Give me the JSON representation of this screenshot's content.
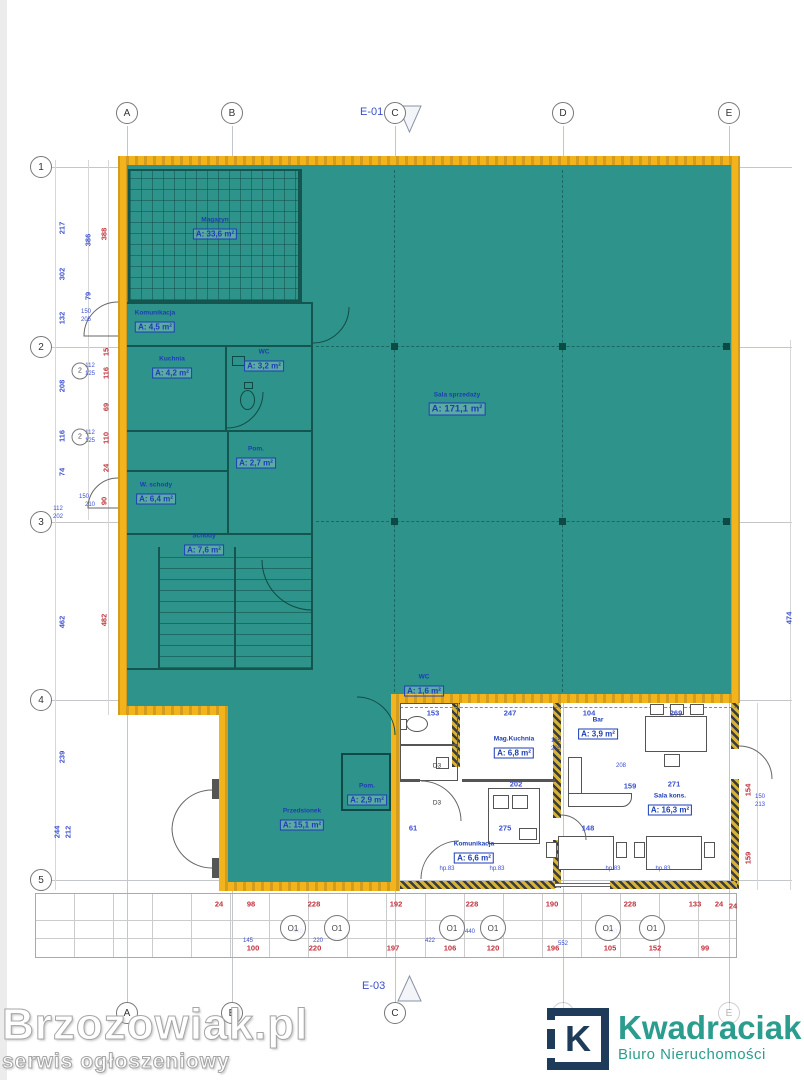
{
  "colors": {
    "highlight_fill": "#2E938A",
    "highlight_border": "#F3B31C",
    "dim_red": "#C2303A",
    "dim_blue": "#3A4FD0",
    "room_label": "#1C3DB4",
    "logo_navy": "#1E3C5A",
    "brand_teal": "#2A9D8F"
  },
  "section_markers": {
    "top": "E-01",
    "bottom": "E-03"
  },
  "grid": {
    "columns": [
      {
        "label": "A",
        "x": 127
      },
      {
        "label": "B",
        "x": 232
      },
      {
        "label": "C",
        "x": 395
      },
      {
        "label": "D",
        "x": 563
      },
      {
        "label": "E",
        "x": 729
      }
    ],
    "rows": [
      {
        "label": "1",
        "y": 167
      },
      {
        "label": "2",
        "y": 347
      },
      {
        "label": "3",
        "y": 522
      },
      {
        "label": "4",
        "y": 700
      },
      {
        "label": "5",
        "y": 880
      }
    ]
  },
  "rooms": [
    {
      "name": "Magazyn",
      "area": "A: 33,6 m²",
      "x": 215,
      "y": 229
    },
    {
      "name": "Komunikacja",
      "area": "A: 4,5 m²",
      "x": 155,
      "y": 322
    },
    {
      "name": "Kuchnia",
      "area": "A: 4,2 m²",
      "x": 172,
      "y": 368
    },
    {
      "name": "WC",
      "area": "A: 3,2 m²",
      "x": 264,
      "y": 361
    },
    {
      "name": "Pom.",
      "area": "A: 2,7 m²",
      "x": 256,
      "y": 458
    },
    {
      "name": "W. schody",
      "area": "A: 6,4 m²",
      "x": 156,
      "y": 494
    },
    {
      "name": "Schody",
      "area": "A: 7,6 m²",
      "x": 204,
      "y": 545
    },
    {
      "name": "Sala sprzedaży",
      "area": "A: 171,1 m²",
      "x": 457,
      "y": 404,
      "cls": "lg"
    },
    {
      "name": "WC",
      "area": "A: 1,6 m²",
      "x": 424,
      "y": 686
    },
    {
      "name": "Pom.",
      "area": "A: 2,9 m²",
      "x": 367,
      "y": 795
    },
    {
      "name": "Przedsionek",
      "area": "A: 15,1 m²",
      "x": 302,
      "y": 820
    },
    {
      "name": "Mag.Kuchnia",
      "area": "A: 6,8 m²",
      "x": 514,
      "y": 748
    },
    {
      "name": "Bar",
      "area": "A: 3,9 m²",
      "x": 598,
      "y": 729
    },
    {
      "name": "Sala kons.",
      "area": "A: 16,3 m²",
      "x": 670,
      "y": 805
    },
    {
      "name": "Komunikacja",
      "area": "A: 6,6 m²",
      "x": 474,
      "y": 853
    }
  ],
  "dims": [
    {
      "t": "217",
      "x": 62,
      "y": 228,
      "cls": "blue v"
    },
    {
      "t": "386",
      "x": 88,
      "y": 240,
      "cls": "blue v"
    },
    {
      "t": "388",
      "x": 104,
      "y": 234,
      "cls": "red v"
    },
    {
      "t": "302",
      "x": 62,
      "y": 274,
      "cls": "blue v"
    },
    {
      "t": "79",
      "x": 88,
      "y": 296,
      "cls": "blue v"
    },
    {
      "t": "132",
      "x": 62,
      "y": 318,
      "cls": "blue v"
    },
    {
      "t": "150",
      "x": 86,
      "y": 312,
      "cls": "blue t2"
    },
    {
      "t": "205",
      "x": 86,
      "y": 320,
      "cls": "blue t2"
    },
    {
      "t": "15",
      "x": 106,
      "y": 352,
      "cls": "red v"
    },
    {
      "t": "208",
      "x": 62,
      "y": 386,
      "cls": "blue v"
    },
    {
      "t": "112",
      "x": 90,
      "y": 366,
      "cls": "blue t2"
    },
    {
      "t": "125",
      "x": 90,
      "y": 374,
      "cls": "blue t2"
    },
    {
      "t": "116",
      "x": 106,
      "y": 373,
      "cls": "red v"
    },
    {
      "t": "69",
      "x": 106,
      "y": 407,
      "cls": "red v"
    },
    {
      "t": "116",
      "x": 62,
      "y": 436,
      "cls": "blue v"
    },
    {
      "t": "112",
      "x": 90,
      "y": 433,
      "cls": "blue t2"
    },
    {
      "t": "125",
      "x": 90,
      "y": 441,
      "cls": "blue t2"
    },
    {
      "t": "110",
      "x": 106,
      "y": 438,
      "cls": "red v"
    },
    {
      "t": "24",
      "x": 106,
      "y": 468,
      "cls": "red v"
    },
    {
      "t": "74",
      "x": 62,
      "y": 472,
      "cls": "blue v"
    },
    {
      "t": "150",
      "x": 84,
      "y": 497,
      "cls": "blue t2"
    },
    {
      "t": "210",
      "x": 90,
      "y": 505,
      "cls": "blue t2"
    },
    {
      "t": "90",
      "x": 104,
      "y": 501,
      "cls": "red v"
    },
    {
      "t": "112",
      "x": 58,
      "y": 509,
      "cls": "blue t2"
    },
    {
      "t": "202",
      "x": 58,
      "y": 517,
      "cls": "blue t2"
    },
    {
      "t": "462",
      "x": 62,
      "y": 622,
      "cls": "blue v"
    },
    {
      "t": "482",
      "x": 104,
      "y": 620,
      "cls": "red v"
    },
    {
      "t": "239",
      "x": 62,
      "y": 757,
      "cls": "blue v"
    },
    {
      "t": "244",
      "x": 57,
      "y": 832,
      "cls": "blue v"
    },
    {
      "t": "212",
      "x": 68,
      "y": 832,
      "cls": "blue v"
    },
    {
      "t": "474",
      "x": 789,
      "y": 618,
      "cls": "blue v"
    },
    {
      "t": "154",
      "x": 748,
      "y": 790,
      "cls": "red v"
    },
    {
      "t": "150",
      "x": 760,
      "y": 797,
      "cls": "blue t2"
    },
    {
      "t": "213",
      "x": 760,
      "y": 805,
      "cls": "blue t2"
    },
    {
      "t": "159",
      "x": 748,
      "y": 858,
      "cls": "red v"
    },
    {
      "t": "24",
      "x": 733,
      "y": 906,
      "cls": "red"
    },
    {
      "t": "24",
      "x": 219,
      "y": 904,
      "cls": "red"
    },
    {
      "t": "98",
      "x": 251,
      "y": 904,
      "cls": "red"
    },
    {
      "t": "228",
      "x": 314,
      "y": 904,
      "cls": "red"
    },
    {
      "t": "192",
      "x": 396,
      "y": 904,
      "cls": "red"
    },
    {
      "t": "228",
      "x": 472,
      "y": 904,
      "cls": "red"
    },
    {
      "t": "190",
      "x": 552,
      "y": 904,
      "cls": "red"
    },
    {
      "t": "228",
      "x": 630,
      "y": 904,
      "cls": "red"
    },
    {
      "t": "133",
      "x": 695,
      "y": 904,
      "cls": "red"
    },
    {
      "t": "24",
      "x": 719,
      "y": 904,
      "cls": "red"
    },
    {
      "t": "100",
      "x": 253,
      "y": 948,
      "cls": "red"
    },
    {
      "t": "220",
      "x": 315,
      "y": 948,
      "cls": "red"
    },
    {
      "t": "197",
      "x": 393,
      "y": 948,
      "cls": "red"
    },
    {
      "t": "106",
      "x": 450,
      "y": 948,
      "cls": "red"
    },
    {
      "t": "120",
      "x": 493,
      "y": 948,
      "cls": "red"
    },
    {
      "t": "196",
      "x": 553,
      "y": 948,
      "cls": "red"
    },
    {
      "t": "105",
      "x": 610,
      "y": 948,
      "cls": "red"
    },
    {
      "t": "152",
      "x": 655,
      "y": 948,
      "cls": "red"
    },
    {
      "t": "99",
      "x": 705,
      "y": 948,
      "cls": "red"
    },
    {
      "t": "145",
      "x": 248,
      "y": 941,
      "cls": "blue t2"
    },
    {
      "t": "440",
      "x": 298,
      "y": 932,
      "cls": "blue t2"
    },
    {
      "t": "220",
      "x": 318,
      "y": 941,
      "cls": "blue t2"
    },
    {
      "t": "422",
      "x": 430,
      "y": 941,
      "cls": "blue t2"
    },
    {
      "t": "440",
      "x": 470,
      "y": 932,
      "cls": "blue t2"
    },
    {
      "t": "552",
      "x": 563,
      "y": 944,
      "cls": "blue t2"
    },
    {
      "t": "440",
      "x": 612,
      "y": 932,
      "cls": "blue t2"
    },
    {
      "t": "153",
      "x": 433,
      "y": 713,
      "cls": "blue"
    },
    {
      "t": "247",
      "x": 510,
      "y": 713,
      "cls": "blue"
    },
    {
      "t": "104",
      "x": 589,
      "y": 713,
      "cls": "blue"
    },
    {
      "t": "269",
      "x": 676,
      "y": 713,
      "cls": "blue"
    },
    {
      "t": "165",
      "x": 556,
      "y": 741,
      "cls": "blue t2"
    },
    {
      "t": "205",
      "x": 556,
      "y": 749,
      "cls": "blue t2"
    },
    {
      "t": "202",
      "x": 516,
      "y": 784,
      "cls": "blue"
    },
    {
      "t": "159",
      "x": 630,
      "y": 786,
      "cls": "blue"
    },
    {
      "t": "271",
      "x": 674,
      "y": 784,
      "cls": "blue"
    },
    {
      "t": "208",
      "x": 621,
      "y": 766,
      "cls": "blue t2"
    },
    {
      "t": "275",
      "x": 505,
      "y": 828,
      "cls": "blue"
    },
    {
      "t": "148",
      "x": 588,
      "y": 828,
      "cls": "blue"
    },
    {
      "t": "61",
      "x": 413,
      "y": 828,
      "cls": "blue"
    },
    {
      "t": "hp.83",
      "x": 447,
      "y": 869,
      "cls": "blue t2"
    },
    {
      "t": "hp.83",
      "x": 497,
      "y": 869,
      "cls": "blue t2"
    },
    {
      "t": "hp.83",
      "x": 613,
      "y": 869,
      "cls": "blue t2"
    },
    {
      "t": "hp.83",
      "x": 663,
      "y": 869,
      "cls": "blue t2"
    }
  ],
  "markers": [
    {
      "t": "O1",
      "x": 293,
      "y": 928,
      "cls": "oc"
    },
    {
      "t": "O1",
      "x": 337,
      "y": 928,
      "cls": "oc"
    },
    {
      "t": "O1",
      "x": 452,
      "y": 928,
      "cls": "oc"
    },
    {
      "t": "O1",
      "x": 493,
      "y": 928,
      "cls": "oc"
    },
    {
      "t": "O1",
      "x": 608,
      "y": 928,
      "cls": "oc"
    },
    {
      "t": "O1",
      "x": 652,
      "y": 928,
      "cls": "oc"
    },
    {
      "t": "2",
      "x": 80,
      "y": 371,
      "cls": "oc sm"
    },
    {
      "t": "2",
      "x": 80,
      "y": 437,
      "cls": "oc sm"
    },
    {
      "t": "D3",
      "x": 437,
      "y": 766,
      "cls": "lbl"
    },
    {
      "t": "D3",
      "x": 437,
      "y": 803,
      "cls": "lbl"
    }
  ],
  "watermark": {
    "title": "Brzozowiak.pl",
    "subtitle": "serwis ogłoszeniowy"
  },
  "logo": {
    "letter": "K",
    "brand": "Kwadraciak",
    "tagline": "Biuro Nieruchomości"
  }
}
